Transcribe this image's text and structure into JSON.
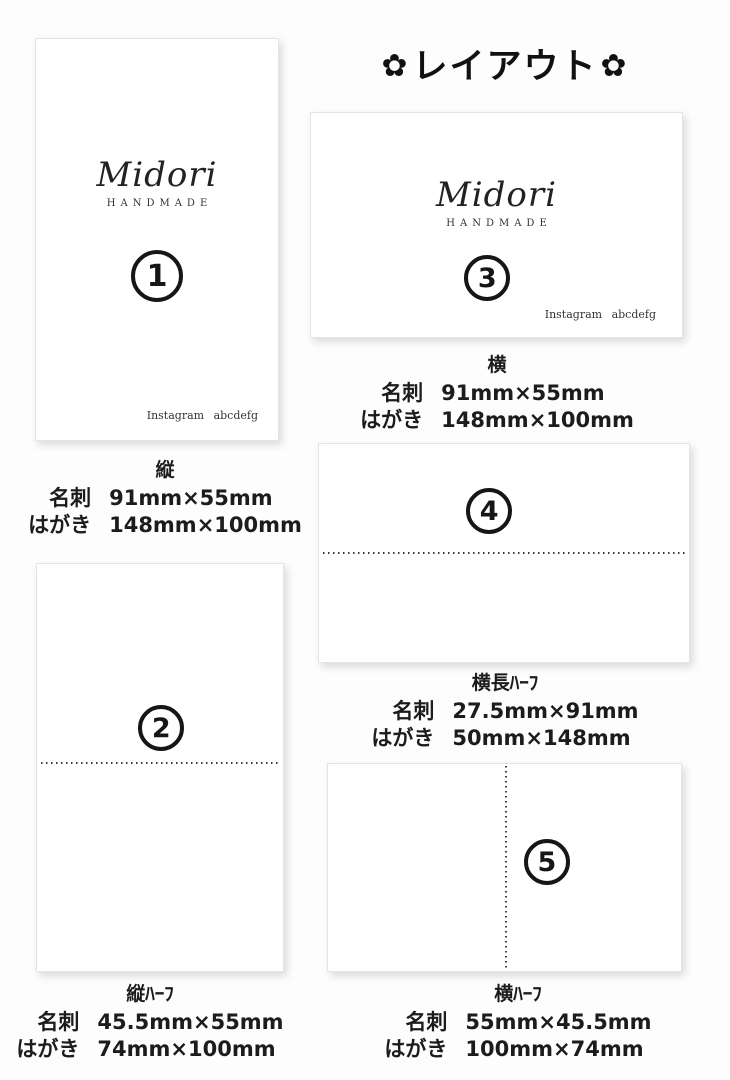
{
  "title": {
    "flower": "✿",
    "text": "レイアウト"
  },
  "brand": {
    "name": "Midori",
    "subtitle": "HANDMADE",
    "instagram": "Instagram abcdefg"
  },
  "layouts": [
    {
      "number": "1",
      "orientation_label": "縦",
      "meishi_label": "名刺",
      "meishi_size": "91mm×55mm",
      "hagaki_label": "はがき",
      "hagaki_size": "148mm×100mm"
    },
    {
      "number": "2",
      "orientation_label": "縦ﾊｰﾌ",
      "meishi_label": "名刺",
      "meishi_size": "45.5mm×55mm",
      "hagaki_label": "はがき",
      "hagaki_size": "74mm×100mm"
    },
    {
      "number": "3",
      "orientation_label": "横",
      "meishi_label": "名刺",
      "meishi_size": "91mm×55mm",
      "hagaki_label": "はがき",
      "hagaki_size": "148mm×100mm"
    },
    {
      "number": "4",
      "orientation_label": "横長ﾊｰﾌ",
      "meishi_label": "名刺",
      "meishi_size": "27.5mm×91mm",
      "hagaki_label": "はがき",
      "hagaki_size": "50mm×148mm"
    },
    {
      "number": "5",
      "orientation_label": "横ﾊｰﾌ",
      "meishi_label": "名刺",
      "meishi_size": "55mm×45.5mm",
      "hagaki_label": "はがき",
      "hagaki_size": "100mm×74mm"
    }
  ],
  "colors": {
    "card_bg": "#ffffff",
    "page_bg": "#fdfdfd",
    "ink": "#1a1a1a"
  }
}
